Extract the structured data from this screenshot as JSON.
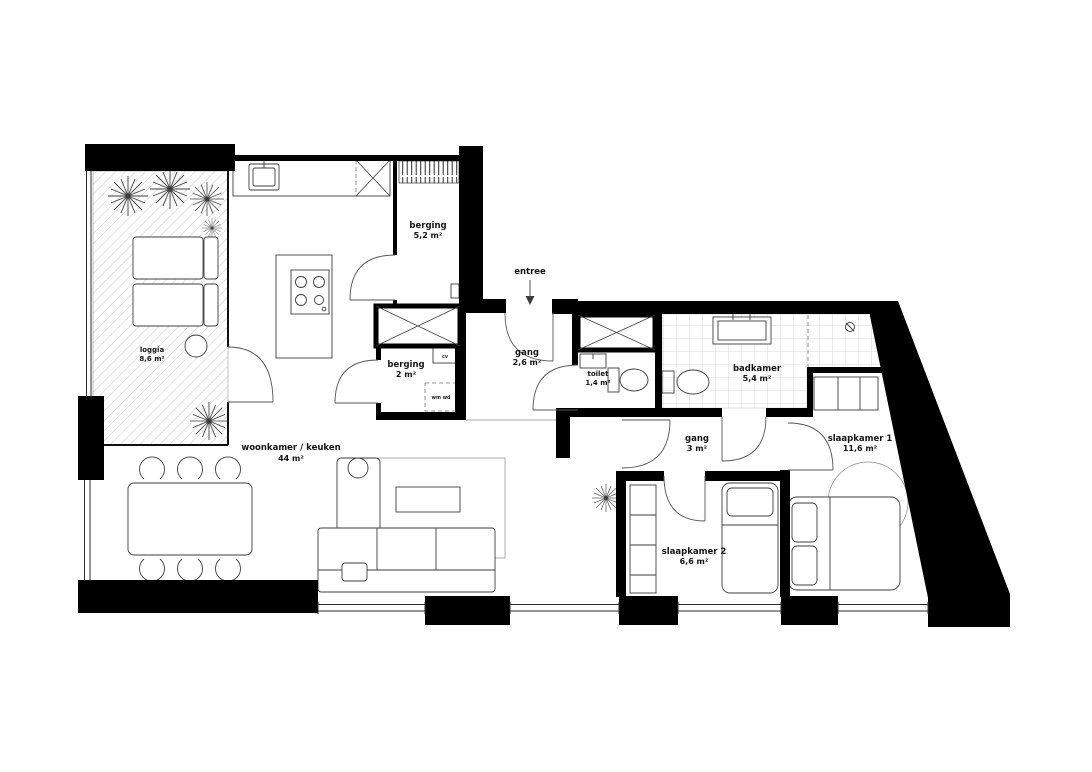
{
  "plan": {
    "type": "floorplan",
    "language": "nl",
    "rooms": [
      {
        "id": "loggia",
        "label": "loggia",
        "area": "8,6 m²"
      },
      {
        "id": "berging-groot",
        "label": "berging",
        "area": "5,2 m²"
      },
      {
        "id": "gang-entree",
        "label": "gang",
        "area": "2,6 m²"
      },
      {
        "id": "berging-klein",
        "label": "berging",
        "area": "2 m²"
      },
      {
        "id": "toilet",
        "label": "toilet",
        "area": "1,4 m²"
      },
      {
        "id": "badkamer",
        "label": "badkamer",
        "area": "5,4 m²"
      },
      {
        "id": "woonkamer-keuken",
        "label": "woonkamer / keuken",
        "area": "44 m²"
      },
      {
        "id": "gang",
        "label": "gang",
        "area": "3 m²"
      },
      {
        "id": "slaapkamer-2",
        "label": "slaapkamer 2",
        "area": "6,6 m²"
      },
      {
        "id": "slaapkamer-1",
        "label": "slaapkamer 1",
        "area": "11,6 m²"
      }
    ],
    "annotations": {
      "entree": "entree",
      "washer_dryer": "wm wd",
      "cv": "cv"
    },
    "colors": {
      "wall": "#000000",
      "furniture_line": "#3d3d3d",
      "tile_line": "#dadada",
      "hatch_line": "#c9c9c9"
    }
  }
}
